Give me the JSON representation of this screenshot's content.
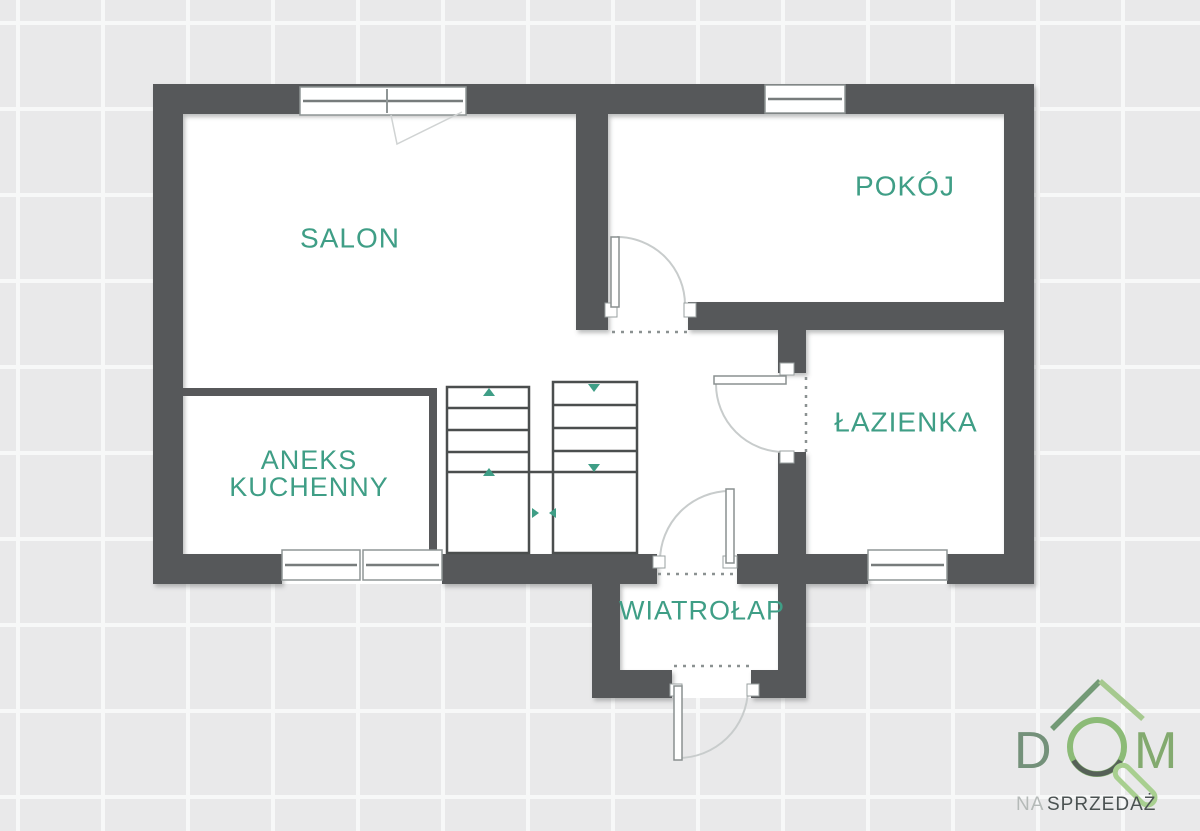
{
  "floorplan": {
    "type": "apartment-floor-plan",
    "wall_color": "#57585a",
    "floor_color": "#ffffff",
    "background_tile_color": "#e9e9ea",
    "label_color": "#3f9e86",
    "labels": {
      "salon": "SALON",
      "pokoj": "POKÓJ",
      "lazienka": "ŁAZIENKA",
      "aneks_line1": "ANEKS",
      "aneks_line2": "KUCHENNY",
      "wiatrolap": "WIATROŁAP"
    },
    "features": {
      "staircase": "double-flight with up/down direction arrows",
      "windows": 5,
      "doors": 4
    }
  },
  "logo": {
    "word_d": "D",
    "word_m": "M",
    "subtitle_na": "NA",
    "subtitle_sprzedaz": "SPRZEDAŻ",
    "roof_green_dark": "#739a76",
    "roof_green_light": "#a6c98f",
    "ring_green": "#8cbb77",
    "handle_green": "#a8cf90",
    "letter_d_color": "#74917a",
    "letter_m_color": "#83aa6f",
    "subtitle_na_color": "#b5bab8",
    "subtitle_sprzedaz_color": "#4b5252"
  }
}
